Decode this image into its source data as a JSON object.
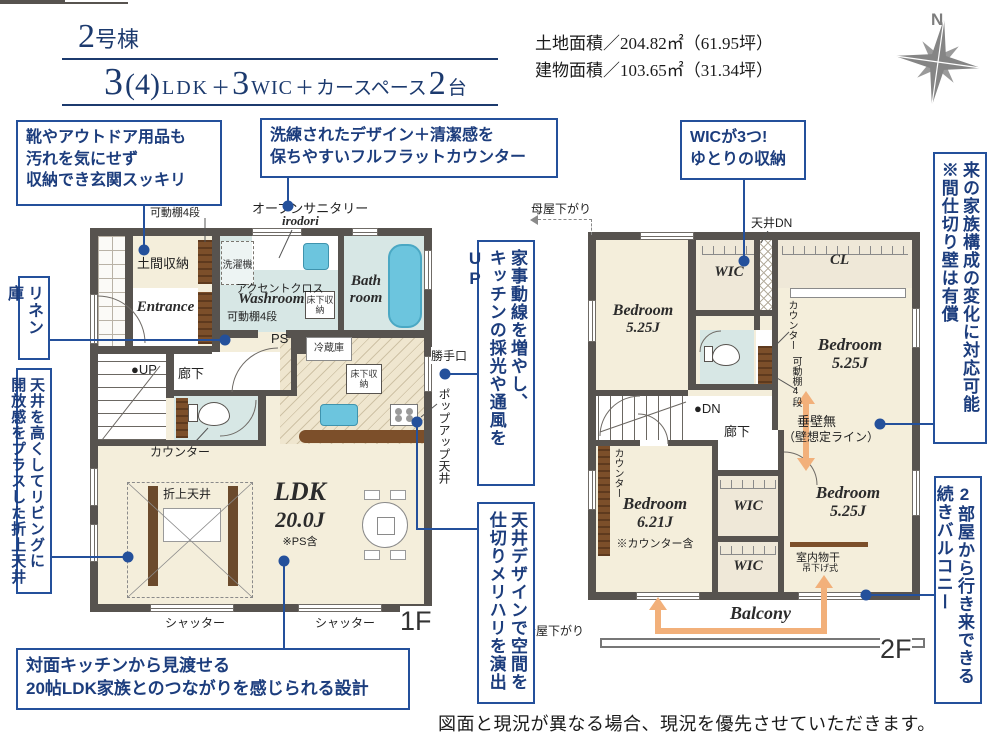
{
  "colors": {
    "accent": "#24509b",
    "text_navy": "#1c3d7d",
    "wall": "#57534f",
    "room_beige": "#f4eedb",
    "wet_blue": "#d7e7e5",
    "tub_blue": "#6cc5de",
    "shelf_brown": "#7c4f2a",
    "arrow_orange": "#f2b07a",
    "compass_gray": "#8a8a8a"
  },
  "header": {
    "building_num": "2",
    "building_suffix": "号棟",
    "layout": {
      "n1": "3",
      "paren": "(4)",
      "ldk": "LDK",
      "plus1": "＋",
      "n2": "3",
      "wic": "WIC",
      "plus2": "＋",
      "car": "カースペース",
      "n3": "2",
      "dai": "台"
    },
    "land_area": "土地面積／204.82㎡（61.95坪）",
    "building_area": "建物面積／103.65㎡（31.34坪）",
    "compass_n": "N"
  },
  "callouts": {
    "shoes": {
      "l1": "靴やアウトドア用品も",
      "l2": "汚れを気にせず",
      "l3": "収納でき玄関スッキリ"
    },
    "flat_counter": {
      "l1": "洗練されたデザイン＋清潔感を",
      "l2": "保ちやすいフルフラットカウンター"
    },
    "wic3": {
      "l1": "WICが3つ!",
      "l2": "ゆとりの収納"
    },
    "partition": {
      "c1": "来の家族構成の変化に対応可能",
      "c2": "※間仕切り壁は有償"
    },
    "linen": "リネン庫",
    "oriage": {
      "c1": "天井を高くしてリビングに",
      "c2": "開放感をプラスした折上天井"
    },
    "housework": {
      "c1": "家事動線を増やし、",
      "c2": "キッチンの採光や通風をUP"
    },
    "ceiling_design": {
      "c1": "天井デザインで空間を",
      "c2": "仕切りメリハリを演出"
    },
    "balcony2": {
      "c1": "2部屋から行き来できる",
      "c2": "続きバルコニー"
    },
    "ldk_view": {
      "l1": "対面キッチンから見渡せる",
      "l2": "20帖LDK家族とのつながりを感じられる設計"
    }
  },
  "floor1": {
    "doma": "土間収納",
    "shelf_l1": "L型",
    "shelf_l2": "可動棚4段",
    "open_sanitary": "オープンサニタリー",
    "irodori": "irodori",
    "washer": "洗濯機",
    "accent": "アクセントクロス",
    "washroom": "Washroom",
    "kadodana": "可動棚4段",
    "yukashita": "床下収納",
    "bath1": "Bath",
    "bath2": "room",
    "entrance": "Entrance",
    "up": "●UP",
    "rouka": "廊下",
    "counter": "カウンター",
    "ps": "PS",
    "fridge": "冷蔵庫",
    "katteguchi": "勝手口",
    "popup": "ポップアップ天井",
    "oriage": "折上天井",
    "ldk": "LDK",
    "ldk_size": "20.0J",
    "ldk_note": "※PS含",
    "shutter": "シャッター",
    "fname": "1F"
  },
  "floor2": {
    "moya": "母屋下がり",
    "tenjo_dn": "天井DN",
    "wic": "WIC",
    "cl": "CL",
    "bed": "Bedroom",
    "s525": "5.25J",
    "s621": "6.21J",
    "counter_note": "※カウンター含",
    "counter": "カウンター",
    "kadodana": "可動棚4段",
    "dn": "●DN",
    "rouka": "廊下",
    "tarekabe": "垂壁無",
    "kabe_line": "（壁想定ライン）",
    "monohoshi": "室内物干",
    "tsuri": "吊下げ式",
    "balcony": "Balcony",
    "fname": "2F"
  },
  "disclaimer": "図面と現況が異なる場合、現況を優先させていただきます。"
}
